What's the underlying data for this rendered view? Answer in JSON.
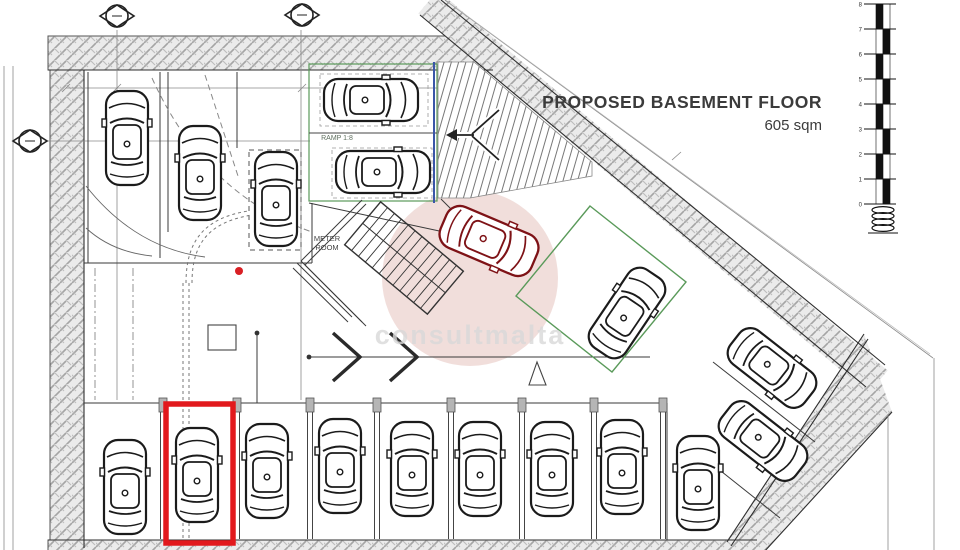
{
  "title": {
    "line1": "PROPOSED BASEMENT FLOOR",
    "line2": "605 sqm"
  },
  "labels": {
    "ramp": "RAMP 1:8",
    "meter_room_line1": "METER",
    "meter_room_line2": "ROOM"
  },
  "watermark": {
    "text": "consultmalta",
    "circle_color": "#e3bdb8",
    "text_color": "#d9d9d9"
  },
  "highlight": {
    "note": "red rectangle marking the highlighted parking space",
    "color": "#e2191d",
    "x": 166,
    "y": 404,
    "w": 67,
    "h": 139
  },
  "red_dot": {
    "x": 239,
    "y": 271,
    "color": "#d91f24"
  },
  "scale_bar": {
    "style": "checkered",
    "tick_labels": [
      "8",
      "7",
      "6",
      "5",
      "4",
      "3",
      "2",
      "1",
      "0"
    ]
  },
  "survey_markers": [
    {
      "x": 117,
      "y": 16
    },
    {
      "x": 302,
      "y": 15
    },
    {
      "x": 30,
      "y": 141
    }
  ],
  "cars": [
    {
      "x": 127,
      "y": 138,
      "rot": 0,
      "color": "#1b1b1b"
    },
    {
      "x": 200,
      "y": 173,
      "rot": 0,
      "color": "#1b1b1b"
    },
    {
      "x": 276,
      "y": 199,
      "rot": 0,
      "color": "#1b1b1b"
    },
    {
      "x": 371,
      "y": 100,
      "rot": 90,
      "color": "#1b1b1b"
    },
    {
      "x": 383,
      "y": 172,
      "rot": 90,
      "color": "#1b1b1b"
    },
    {
      "x": 489,
      "y": 241,
      "rot": 113,
      "color": "#7e1216",
      "scale": 1.05
    },
    {
      "x": 627,
      "y": 313,
      "rot": 34,
      "color": "#1b1b1b"
    },
    {
      "x": 772,
      "y": 368,
      "rot": 128,
      "color": "#1b1b1b"
    },
    {
      "x": 763,
      "y": 441,
      "rot": 128,
      "color": "#1b1b1b"
    },
    {
      "x": 125,
      "y": 487,
      "rot": 0,
      "color": "#1b1b1b"
    },
    {
      "x": 197,
      "y": 475,
      "rot": 0,
      "color": "#1b1b1b"
    },
    {
      "x": 267,
      "y": 471,
      "rot": 0,
      "color": "#1b1b1b"
    },
    {
      "x": 340,
      "y": 466,
      "rot": 0,
      "color": "#1b1b1b"
    },
    {
      "x": 412,
      "y": 469,
      "rot": 0,
      "color": "#1b1b1b"
    },
    {
      "x": 480,
      "y": 469,
      "rot": 0,
      "color": "#1b1b1b"
    },
    {
      "x": 552,
      "y": 469,
      "rot": 0,
      "color": "#1b1b1b"
    },
    {
      "x": 622,
      "y": 467,
      "rot": 0,
      "color": "#1b1b1b"
    },
    {
      "x": 698,
      "y": 483,
      "rot": 0,
      "color": "#1b1b1b"
    }
  ],
  "colors": {
    "accent_red": "#e2191d",
    "green_line": "#5a9a5a",
    "blue_line": "#3a56a8",
    "wall_hatch": "#9a9a9a"
  }
}
